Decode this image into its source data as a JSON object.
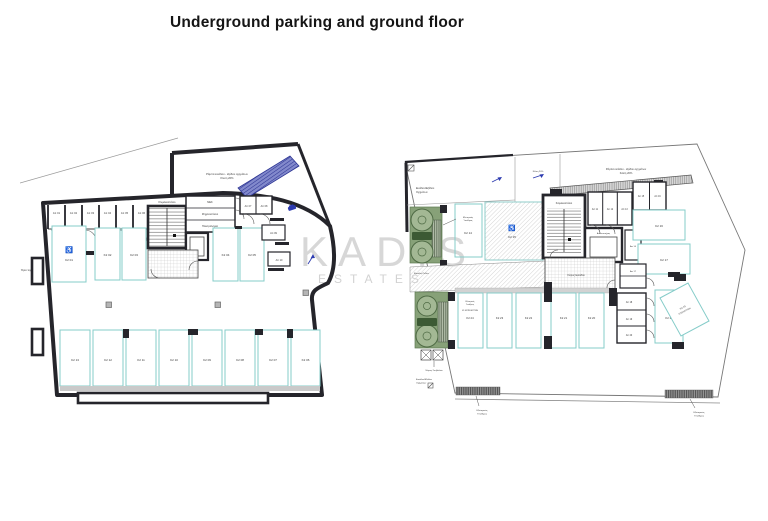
{
  "page": {
    "title": "Underground parking and ground floor"
  },
  "watermark": {
    "brand": "KADIS",
    "sub": "ESTATES"
  },
  "colors": {
    "wall": "#25252b",
    "parking_outline": "#85ccc9",
    "ramp_blue": "#7d84c9",
    "tree_fill": "#a3b894",
    "planter_fill": "#87a178",
    "chip_fill": "#3c5a34",
    "hatch_gray": "#aaaaaa"
  },
  "underground": {
    "ramp_note_line1": "Ράμπα εισόδου - εξόδου οχημάτων",
    "ramp_note_line2": "Κλίση 20%",
    "boundary_note": "Όριο τεμαχίου",
    "staircase": "Κλιμακοστάσιο",
    "elevator": "Ανελκυστήρας",
    "rooms": {
      "mek": "ΜΕΚ",
      "machine": "Μηχανοστάσιο",
      "electrical": "Ηλεκτρολογείο"
    },
    "storage": [
      "Απ 01",
      "Απ 02",
      "Απ 03",
      "Απ 04",
      "Απ 05",
      "Απ 06",
      "Απ 07",
      "Απ 08",
      "Απ 09",
      "Απ 10"
    ],
    "parking_top": [
      "Κ2 01",
      "Κ2 02",
      "Κ2 03"
    ],
    "parking_mid": [
      "Κ2 04",
      "Κ2 05"
    ],
    "parking_bottom": [
      "Κ2 13",
      "Κ2 12",
      "Κ2 11",
      "Κ2 10",
      "Κ2 09",
      "Κ2 08",
      "Κ2 07",
      "Κ2 06"
    ],
    "handicap_symbol": "♿"
  },
  "ground": {
    "ramp_note_line1": "Ράμπα εισόδου - εξόδου οχημάτων",
    "ramp_note_line2": "Κλίση 20%",
    "slope_note": "Κλίση 20%",
    "vehicle_access_line1": "Εισόδου/Εξόδου",
    "vehicle_access_line2": "Οχημάτων",
    "staircase": "Κλιμακοστάσιο",
    "elevator": "Ανελκυστήρας",
    "entrance": "Χώρος Εισόδου",
    "cafe": "Cafe",
    "pedestrian": "Είσοδος Πεζών",
    "garbage": "Χώρος Σκυβάλων",
    "outdoor_line1": "Εξωτερικός",
    "outdoor_line2": "Υπαίθριος",
    "visitors_k1": "Κ1 ΕΠΙΣΚΕΠΤΩΝ",
    "storage_top": [
      "Απ 11",
      "Απ 12",
      "Απ 13",
      "Απ 15",
      "Απ 16"
    ],
    "storage_mid": "Απ 14",
    "storage_mid2": "Απ 17",
    "storage_right": [
      "Απ 18",
      "Απ 19",
      "Απ 20"
    ],
    "parking": {
      "k14": "Κ2 14",
      "k15": "Κ2 15",
      "k16": "Κ2 16",
      "k17": "Κ2 17",
      "k18": "Κ2 18",
      "k19_line1": "Κ2 19",
      "k19_line2": "ΕΠΙΣΚΕΠΤΩΝ",
      "bottom": [
        "Κ2 24",
        "Κ2 23",
        "Κ2 22",
        "Κ2 21",
        "Κ2 20"
      ]
    },
    "handicap_symbol": "♿"
  }
}
